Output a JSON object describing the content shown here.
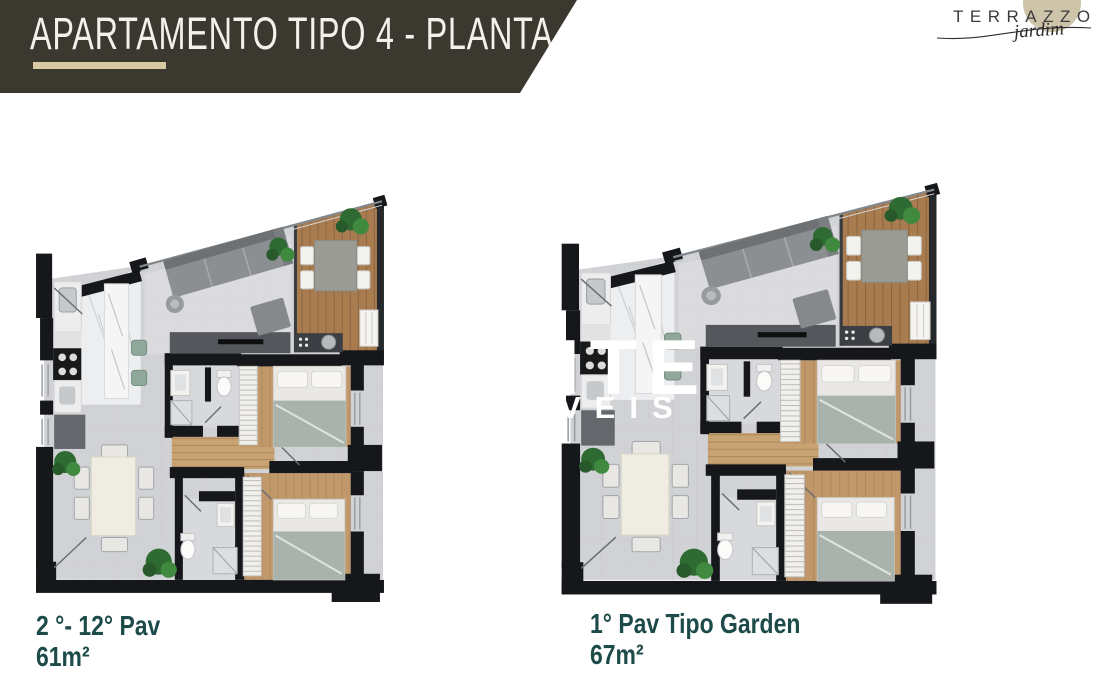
{
  "header": {
    "title": "APARTAMENTO TIPO 4 - PLANTA"
  },
  "logo": {
    "brand": "TERRAZZO",
    "sub": "jardim"
  },
  "watermark": {
    "line1": "ITE",
    "line2": "VEIS"
  },
  "plans": [
    {
      "label": "2 °- 12° Pav",
      "area": "61m²"
    },
    {
      "label": "1° Pav Tipo Garden",
      "area": "67m²"
    }
  ],
  "colors": {
    "banner_bg": "#3a382f",
    "banner_text": "#f3f1ec",
    "gold_accent": "#d9caa3",
    "logo_circle": "#cdc4aa",
    "label_teal": "#1d4b49",
    "wall_black": "#15171a",
    "floor_gray": "#d1d2d5",
    "wood": "#a97c50",
    "watermark_white": "#ffffff"
  }
}
